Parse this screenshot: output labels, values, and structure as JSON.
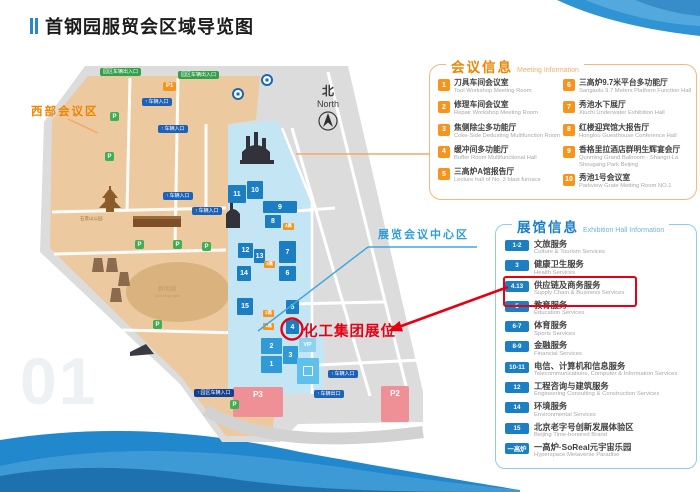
{
  "page": {
    "title": "首钢园服贸会区域导览图",
    "watermark": "01"
  },
  "colors": {
    "orange": "#F08300",
    "blue": "#1C7FC4",
    "red": "#E60012",
    "map_tan": "#ECC99E",
    "map_blue_strip": "#C3E5F4"
  },
  "map": {
    "west_area_label": "西部会议区",
    "center_area_label": "展览会议中心区",
    "booth_label": "化工集团展位",
    "compass_zh": "北",
    "compass_en": "North",
    "park_label": "石景山公园",
    "lake_label_zh": "群明湖",
    "lake_label_en": "Qunming Lake",
    "arrow_icon": "↑",
    "p_marker_label": "P",
    "buildings": [
      {
        "n": "11",
        "x": 198,
        "y": 123,
        "w": 18,
        "h": 18,
        "t": "dark"
      },
      {
        "n": "10",
        "x": 217,
        "y": 119,
        "w": 16,
        "h": 18,
        "t": "dark"
      },
      {
        "n": "9",
        "x": 233,
        "y": 139,
        "w": 34,
        "h": 12,
        "t": "dark"
      },
      {
        "n": "8",
        "x": 235,
        "y": 153,
        "w": 16,
        "h": 13,
        "t": "dark"
      },
      {
        "n": "12",
        "x": 208,
        "y": 181,
        "w": 15,
        "h": 15,
        "t": "dark"
      },
      {
        "n": "13",
        "x": 224,
        "y": 187,
        "w": 11,
        "h": 14,
        "t": "dark"
      },
      {
        "n": "7",
        "x": 249,
        "y": 179,
        "w": 17,
        "h": 22,
        "t": "dark"
      },
      {
        "n": "14",
        "x": 207,
        "y": 204,
        "w": 14,
        "h": 15,
        "t": "dark"
      },
      {
        "n": "6",
        "x": 249,
        "y": 204,
        "w": 17,
        "h": 15,
        "t": "dark"
      },
      {
        "n": "15",
        "x": 207,
        "y": 236,
        "w": 16,
        "h": 17,
        "t": "dark"
      },
      {
        "n": "5",
        "x": 256,
        "y": 238,
        "w": 13,
        "h": 14,
        "t": "dark"
      },
      {
        "n": "4",
        "x": 256,
        "y": 258,
        "w": 13,
        "h": 14,
        "t": "dark"
      },
      {
        "n": "2",
        "x": 231,
        "y": 276,
        "w": 21,
        "h": 16,
        "t": "mid"
      },
      {
        "n": "3",
        "x": 253,
        "y": 284,
        "w": 15,
        "h": 18,
        "t": "mid"
      },
      {
        "n": "1",
        "x": 231,
        "y": 294,
        "w": 21,
        "h": 17,
        "t": "mid"
      },
      {
        "n": "VIP",
        "x": 269,
        "y": 276,
        "w": 17,
        "h": 14,
        "t": "light"
      },
      {
        "n": "",
        "x": 267,
        "y": 296,
        "w": 22,
        "h": 26,
        "t": "hall",
        "icon": "hall-icon"
      }
    ],
    "furnace_badges": [
      {
        "t": "4高",
        "x": 253,
        "y": 161
      },
      {
        "t": "3高",
        "x": 234,
        "y": 199
      },
      {
        "t": "2高",
        "x": 233,
        "y": 248
      },
      {
        "t": "1高",
        "x": 233,
        "y": 261
      }
    ],
    "pills": [
      {
        "t": "园区车辆出入口",
        "c": "green",
        "x": 70,
        "y": 6
      },
      {
        "t": "园区车辆出入口",
        "c": "green",
        "x": 148,
        "y": 9
      },
      {
        "t": "车辆入口",
        "c": "blue",
        "x": 112,
        "y": 36
      },
      {
        "t": "车辆入口",
        "c": "blue",
        "x": 128,
        "y": 63
      },
      {
        "t": "车辆入口",
        "c": "blue",
        "x": 133,
        "y": 130
      },
      {
        "t": "车辆入口",
        "c": "blue",
        "x": 162,
        "y": 145
      },
      {
        "t": "车辆入口",
        "c": "blue",
        "x": 298,
        "y": 308
      },
      {
        "t": "车辆出口",
        "c": "blue",
        "x": 284,
        "y": 328
      },
      {
        "t": "园区车辆入口",
        "c": "navy",
        "x": 164,
        "y": 327
      },
      {
        "t": "P1",
        "c": "orange",
        "x": 133,
        "y": 20
      }
    ],
    "parking_areas": [
      {
        "t": "P3",
        "x": 203,
        "y": 325,
        "w": 50,
        "h": 27
      },
      {
        "t": "P2",
        "x": 351,
        "y": 324,
        "w": 28,
        "h": 33
      }
    ],
    "p_markers": [
      [
        80,
        50
      ],
      [
        75,
        90
      ],
      [
        105,
        178
      ],
      [
        143,
        178
      ],
      [
        172,
        180
      ],
      [
        123,
        258
      ],
      [
        200,
        338
      ]
    ]
  },
  "meeting_info": {
    "title_zh": "会议信息",
    "title_en": "Meeting Information",
    "items": [
      {
        "num": "1",
        "zh": "刀具车间会议室",
        "en": "Tool Workshop Meeting Room"
      },
      {
        "num": "2",
        "zh": "修理车间会议室",
        "en": "Repair Workshop Meeting Room"
      },
      {
        "num": "3",
        "zh": "焦侧除尘多功能厅",
        "en": "Coke-Side Dedusting Multifunction Room"
      },
      {
        "num": "4",
        "zh": "缓冲间多功能厅",
        "en": "Buffer Room Multifunctional Hall"
      },
      {
        "num": "5",
        "zh": "三高炉A馆报告厅",
        "en": "Lecture hall of No. 3 blast furnace"
      },
      {
        "num": "6",
        "zh": "三高炉9.7米平台多功能厅",
        "en": "Sangaolu 9.7 Meters Platform Function Hall"
      },
      {
        "num": "7",
        "zh": "秀池水下展厅",
        "en": "Xiuchi Underwater Exhibition Hall"
      },
      {
        "num": "8",
        "zh": "红楼迎宾馆大报告厅",
        "en": "Honglou Guesthouse Conference Hall"
      },
      {
        "num": "9",
        "zh": "香格里拉酒店群明生辉宴会厅",
        "en": "Qunming Grand Ballroom - Shangri-La Shougang Park Beijing"
      },
      {
        "num": "10",
        "zh": "秀池1号会议室",
        "en": "Parkview Grate Metting Room NO.1"
      }
    ]
  },
  "exhibition_info": {
    "title_zh": "展馆信息",
    "title_en": "Exhibition Hall Information",
    "items": [
      {
        "num": "1-2",
        "zh": "文旅服务",
        "en": "Culture & Tourism Services"
      },
      {
        "num": "3",
        "zh": "健康卫生服务",
        "en": "Health Services"
      },
      {
        "num": "4.13",
        "zh": "供应链及商务服务",
        "en": "Supply Chain & Business Services",
        "highlight": true
      },
      {
        "num": "5",
        "zh": "教育服务",
        "en": "Education Services"
      },
      {
        "num": "6-7",
        "zh": "体育服务",
        "en": "Sports Services"
      },
      {
        "num": "8-9",
        "zh": "金融服务",
        "en": "Financial Services"
      },
      {
        "num": "10-11",
        "zh": "电信、计算机和信息服务",
        "en": "Telecommunications, Computer & Information Services"
      },
      {
        "num": "12",
        "zh": "工程咨询与建筑服务",
        "en": "Engineering Consulting & Construction Services"
      },
      {
        "num": "14",
        "zh": "环境服务",
        "en": "Environmental Services"
      },
      {
        "num": "15",
        "zh": "北京老字号创新发展体验区",
        "en": "Beijing Time-honored Brand"
      },
      {
        "num": "一高炉",
        "zh": "一高炉·SoReal元宇宙乐园",
        "en": "Hyperspace Metaverse Paradise"
      }
    ]
  }
}
